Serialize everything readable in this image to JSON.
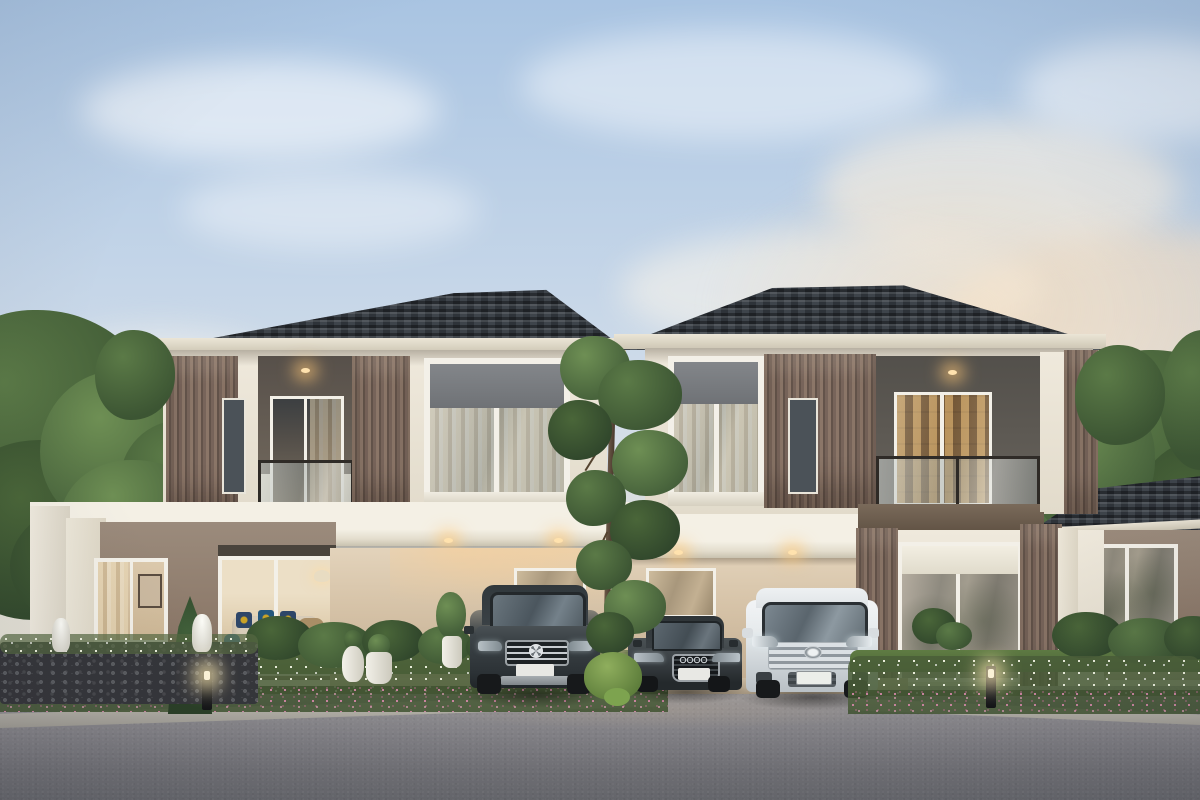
{
  "scene": {
    "type": "architectural-exterior-render",
    "description": "Dusk 3D rendering of a modern two-storey duplex (twin houses) with dark hipped tile roofs, cream walls, wood-slat accent panels, glass balconies, landscaped flower beds, glowing bollard lights and three cars parked in the shared carport forecourt",
    "time_of_day": "dusk",
    "sky": {
      "top": "#a9c4e2",
      "mid": "#d3deea",
      "horizon_warm": "#ecdfcd"
    },
    "palette": {
      "roof_tile": "#343a41",
      "roof_fascia": "#ddd6c8",
      "wall_cream": "#efe9dd",
      "wall_taupe": "#8f7f70",
      "carport_wall": "#d9c8b0",
      "slat_wood": "#7c685a",
      "spandrel_gray": "#7c7f83",
      "window_frame": "#f4f1e9",
      "glass": "#9aa3a8",
      "warm_light": "#ffc07a",
      "foliage": "#4e6b3c",
      "flowers_white": "#eef0e0",
      "flowers_pink": "#c77e9b",
      "asphalt": "#82838a"
    },
    "objects": {
      "left_house": "Left duplex unit: two-storey facade with glass-railing balcony, wood-slat panels and a single-storey living wing with garden windows",
      "right_house": "Right duplex unit: mirrored two-storey facade with recessed lit balcony and ground-floor glass doors",
      "right_wing": "Right single-storey patio wing with hipped roof, glass doors, two wicker chairs and a barrel side table",
      "carport": "Shared carport with warm recessed downlights and two windows behind the cars",
      "suv": "Dark grey luxury SUV with three-pointed-star grille parked on the left bay",
      "sedan": "Dark grey four-ring sedan parked in the centre bay",
      "minivan": "White luxury minivan parked on the right bay",
      "centre_tree": "Slender deciduous tree standing between the two units",
      "garden": "Front beds of white and pink flowers with trimmed shrubs, conifers and grass strips",
      "stone_wall": "Low gabion stone wall at the left with white blossoms and two small white fountain ornaments",
      "bollard_lights": "Three glowing black garden bollard lights",
      "driveway": "Wide grey asphalt forecourt in the foreground"
    },
    "vehicles": [
      {
        "type": "suv",
        "color": "#3c4348"
      },
      {
        "type": "sedan",
        "color": "#3c4246"
      },
      {
        "type": "minivan",
        "color": "#eef0f2"
      }
    ],
    "lights": {
      "balcony_downlights": 2,
      "canopy_downlights": 4,
      "bollards": 3
    }
  }
}
